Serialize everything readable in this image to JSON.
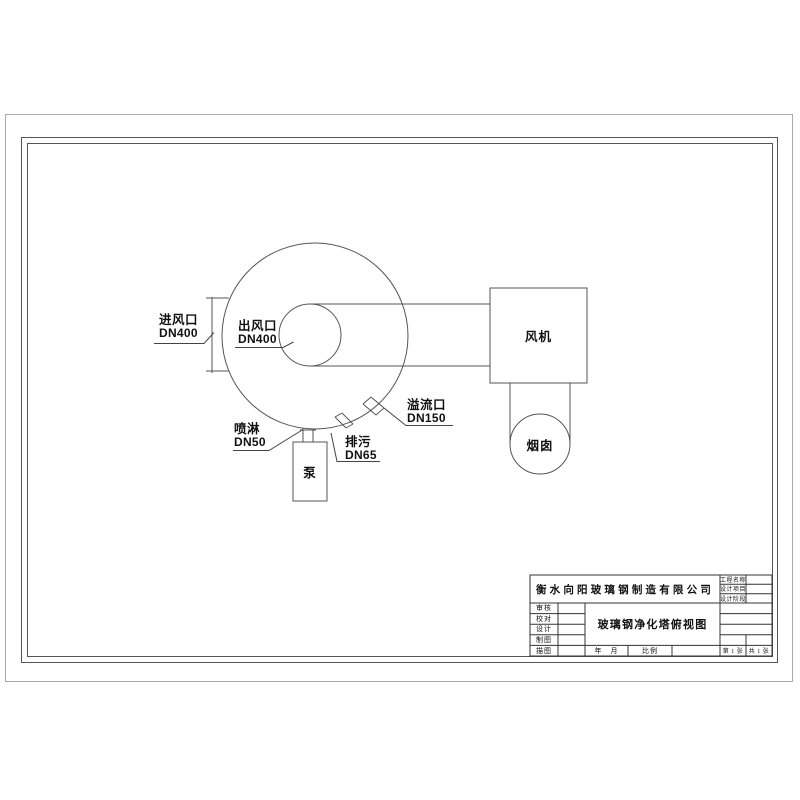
{
  "drawing": {
    "labels": {
      "inlet": {
        "name": "进风口",
        "size": "DN400"
      },
      "outlet": {
        "name": "出风口",
        "size": "DN400"
      },
      "spray": {
        "name": "喷淋",
        "size": "DN50"
      },
      "drain": {
        "name": "排污",
        "size": "DN65"
      },
      "overflow": {
        "name": "溢流口",
        "size": "DN150"
      },
      "pump": "泵",
      "fan": "风机",
      "chimney": "烟囱"
    },
    "colors": {
      "line": "#555555",
      "leader": "#444444",
      "text": "#111111",
      "paper_edge": "#aaaaaa",
      "background": "#ffffff"
    }
  },
  "title_block": {
    "company": "衡水向阳玻璃钢制造有限公司",
    "drawing_title": "玻璃钢净化塔俯视图",
    "right_fields": [
      "工程名称",
      "设计项目",
      "设计阶段"
    ],
    "left_fields": [
      "审核",
      "校对",
      "设计",
      "制图",
      "描图"
    ],
    "date_label": "年　月",
    "scale_label": "比例",
    "sheet_label": "第 1 张",
    "sheet_total_label": "共 1 张"
  }
}
